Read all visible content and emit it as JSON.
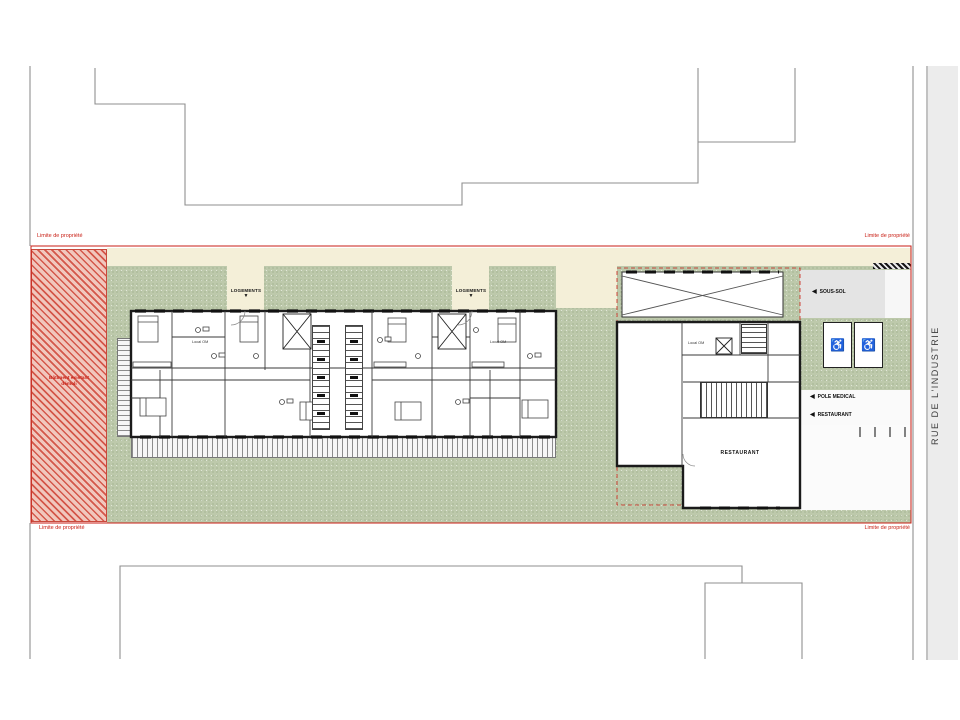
{
  "drawing": {
    "street": {
      "name": "RUE DE L'INDUSTRIE"
    },
    "property": {
      "boundary_label": "Limite de propriété",
      "demolition_zone": {
        "line1": "Bâtiment existant",
        "line2": "démoli"
      }
    },
    "entrances": {
      "logements": "LOGEMENTS",
      "down_arrow": "▼"
    },
    "side_labels": {
      "left_arrow": "◀",
      "sous_sol": "SOUS-SOL",
      "pole_medical": "POLE MEDICAL",
      "restaurant": "RESTAURANT"
    },
    "rooms": {
      "restaurant": "RESTAURANT",
      "local_om": "Local OM"
    },
    "icons": {
      "wheelchair": "♿"
    },
    "colors": {
      "boundary_red": "#c81e14",
      "lawn_green": "#bdc9ab",
      "path_cream": "#f4efd8",
      "street_gray": "#ececec",
      "demolition_hatch_red": "#d4574a",
      "wall_black": "#1b1b1b"
    }
  }
}
